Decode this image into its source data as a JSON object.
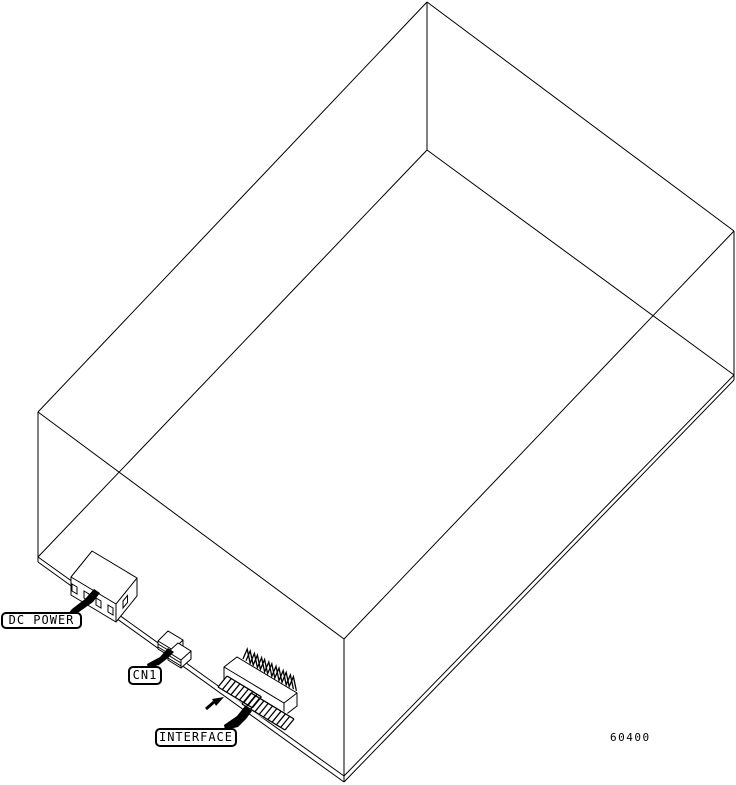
{
  "figure": {
    "background_color": "#ffffff",
    "line_color": "#000000",
    "figure_number": "60400",
    "callouts": [
      {
        "id": "dc_power",
        "text": "DC POWER"
      },
      {
        "id": "cn1",
        "text": "CN1"
      },
      {
        "id": "interface",
        "text": "INTERFACE"
      }
    ]
  }
}
